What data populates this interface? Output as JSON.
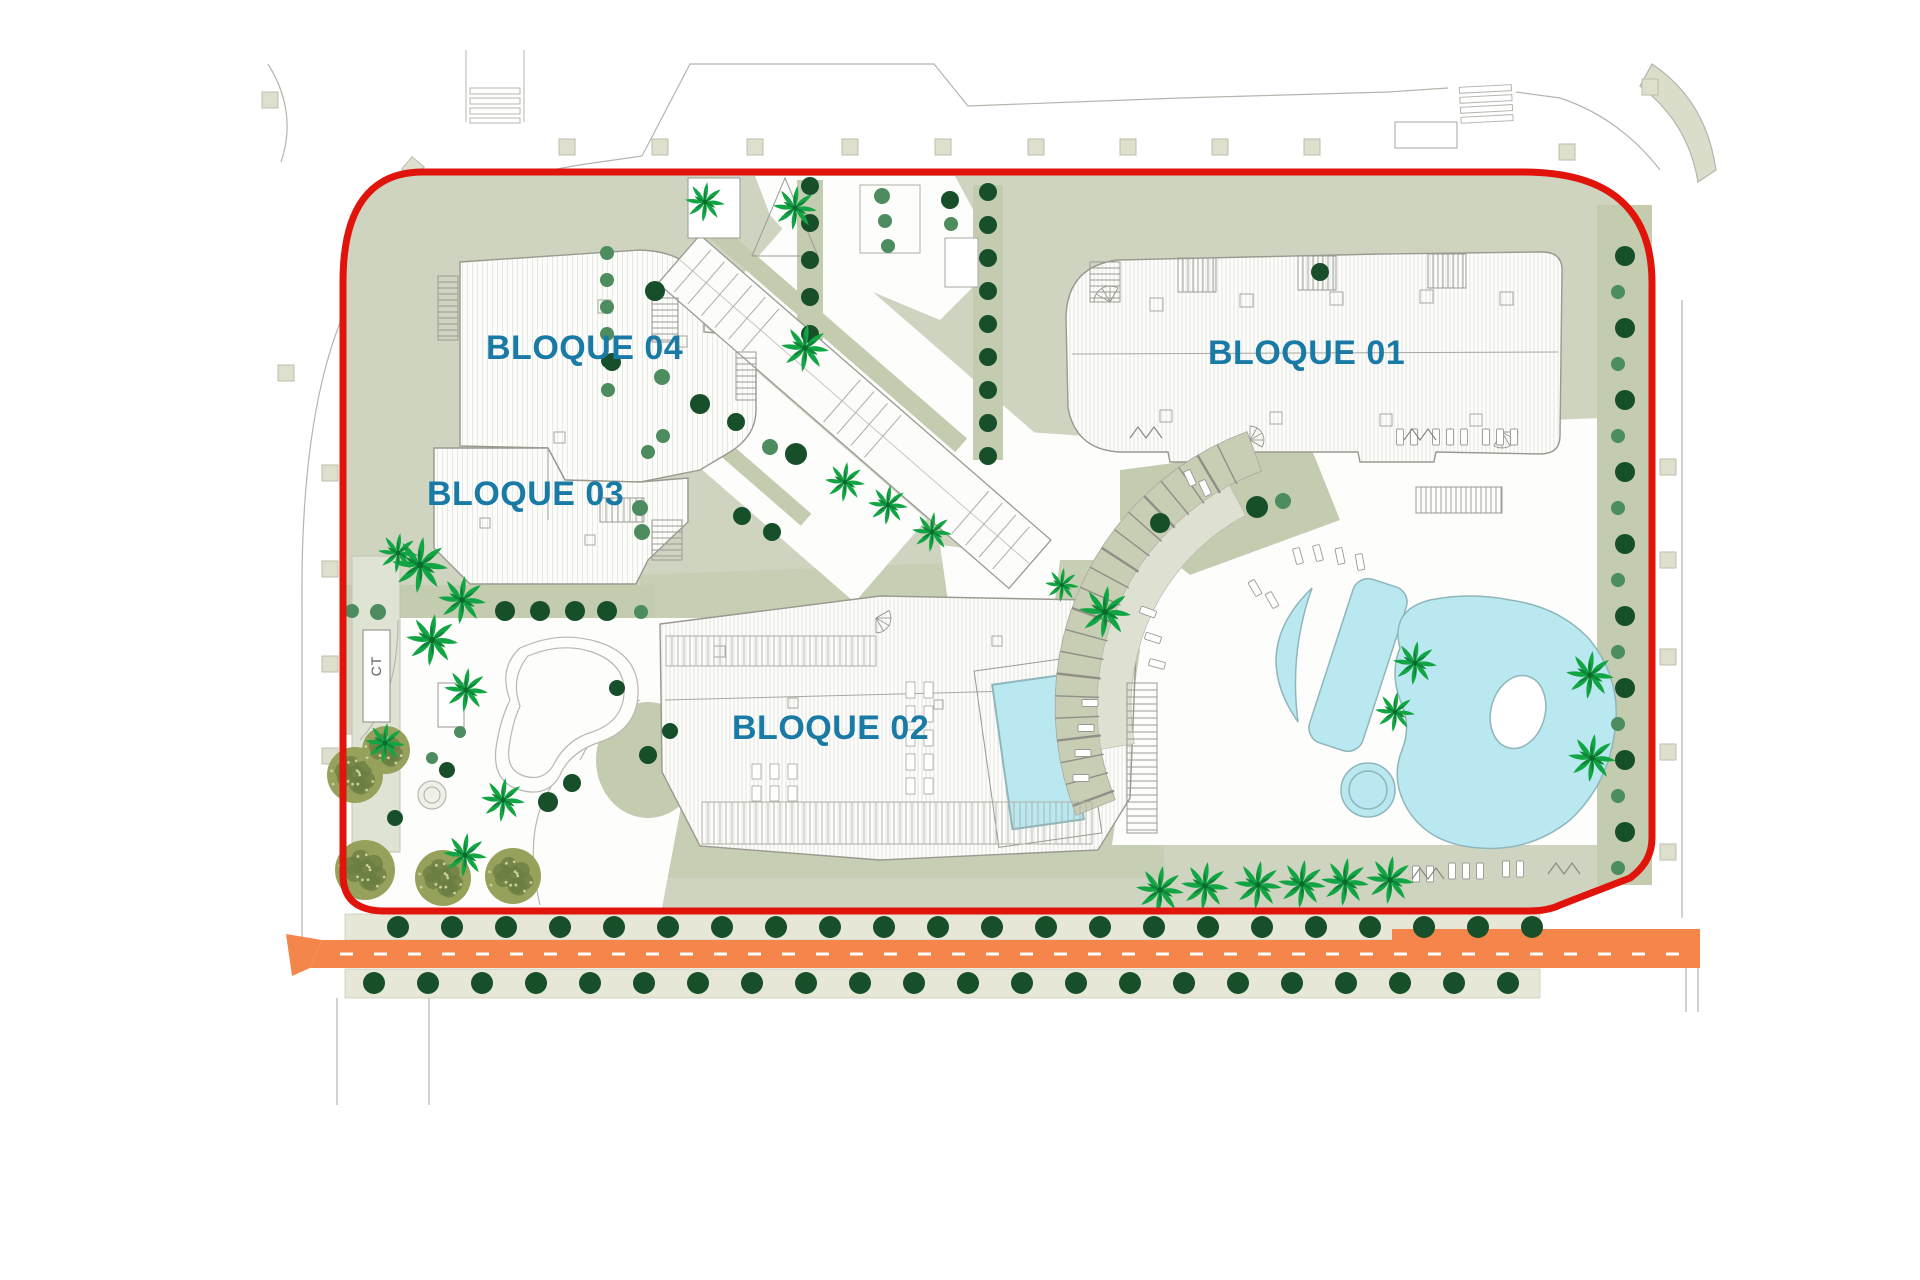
{
  "plan": {
    "type": "residential-site-plan",
    "labels": {
      "block01": "BLOQUE 01",
      "block02": "BLOQUE 02",
      "block03": "BLOQUE 03",
      "block04": "BLOQUE 04",
      "transformer": "CT"
    }
  },
  "colors": {
    "site_green": "#CFD4C0",
    "hedge_green": "#C4CCB0",
    "boundary_red": "#E1140C",
    "label_blue": "#1A7AA6",
    "pool_cyan": "#B9E8F1",
    "pool_edge": "#8FB6BA",
    "road_orange": "#F5864B",
    "path_beige": "#E7E7D7",
    "tree_dark": "#174F2B",
    "tree_medium": "#4C8C5E",
    "palm_green": "#12A544",
    "olive_green": "#96A15B",
    "olive_dark": "#6B7D41",
    "line_gray": "#9A9A94",
    "building_white": "#FDFDFB"
  },
  "landscape": {
    "tree_rows": [
      {
        "name": "road-north-row",
        "vertical": false,
        "x0": 398,
        "x1": 1535,
        "y": 927,
        "step": 54,
        "r": 11,
        "type": "d"
      },
      {
        "name": "road-south-row",
        "vertical": false,
        "x0": 374,
        "x1": 1530,
        "y": 983,
        "step": 54,
        "r": 11,
        "type": "d"
      },
      {
        "name": "bloque01-west-hedge-row",
        "vertical": true,
        "x": 988,
        "y0": 192,
        "y1": 458,
        "step": 33,
        "r": 9,
        "type": "d"
      },
      {
        "name": "plaza-west-hedge-row",
        "vertical": true,
        "x": 810,
        "y0": 186,
        "y1": 334,
        "step": 37,
        "r": 9,
        "type": "d"
      },
      {
        "name": "east-boundary-row",
        "vertical": true,
        "x": 1622,
        "y0": 256,
        "y1": 876,
        "step": 36,
        "r": 10,
        "type": "alt"
      }
    ],
    "trees": [
      [
        655,
        291,
        10,
        "d"
      ],
      [
        612,
        362,
        9,
        "d"
      ],
      [
        662,
        377,
        8,
        "m"
      ],
      [
        700,
        404,
        10,
        "d"
      ],
      [
        736,
        422,
        9,
        "d"
      ],
      [
        770,
        447,
        8,
        "m"
      ],
      [
        796,
        454,
        11,
        "d"
      ],
      [
        742,
        516,
        9,
        "d"
      ],
      [
        772,
        532,
        9,
        "d"
      ],
      [
        882,
        196,
        8,
        "m"
      ],
      [
        885,
        221,
        7,
        "m"
      ],
      [
        888,
        246,
        7,
        "m"
      ],
      [
        950,
        200,
        9,
        "d"
      ],
      [
        951,
        224,
        7,
        "m"
      ],
      [
        1320,
        272,
        9,
        "d"
      ],
      [
        1160,
        523,
        10,
        "d"
      ],
      [
        1257,
        507,
        11,
        "d"
      ],
      [
        1283,
        501,
        8,
        "m"
      ],
      [
        648,
        452,
        7,
        "m"
      ],
      [
        663,
        436,
        7,
        "m"
      ],
      [
        640,
        508,
        8,
        "m"
      ],
      [
        642,
        532,
        8,
        "m"
      ],
      [
        607,
        253,
        7,
        "m"
      ],
      [
        607,
        280,
        7,
        "m"
      ],
      [
        607,
        307,
        7,
        "m"
      ],
      [
        607,
        334,
        7,
        "m"
      ],
      [
        608,
        361,
        7,
        "d"
      ],
      [
        608,
        390,
        7,
        "m"
      ],
      [
        352,
        611,
        7,
        "m"
      ],
      [
        378,
        612,
        8,
        "m"
      ],
      [
        505,
        611,
        10,
        "d"
      ],
      [
        540,
        611,
        10,
        "d"
      ],
      [
        575,
        611,
        10,
        "d"
      ],
      [
        607,
        611,
        10,
        "d"
      ],
      [
        641,
        612,
        7,
        "m"
      ],
      [
        447,
        770,
        8,
        "d"
      ],
      [
        395,
        818,
        8,
        "d"
      ],
      [
        548,
        802,
        10,
        "d"
      ],
      [
        572,
        783,
        9,
        "d"
      ],
      [
        648,
        755,
        9,
        "d"
      ],
      [
        670,
        731,
        8,
        "d"
      ],
      [
        617,
        688,
        8,
        "d"
      ],
      [
        432,
        758,
        6,
        "m"
      ],
      [
        460,
        732,
        6,
        "m"
      ]
    ],
    "palms": [
      [
        705,
        202,
        20
      ],
      [
        795,
        208,
        22
      ],
      [
        805,
        348,
        24
      ],
      [
        845,
        482,
        20
      ],
      [
        888,
        505,
        20
      ],
      [
        932,
        532,
        20
      ],
      [
        1062,
        585,
        17
      ],
      [
        1105,
        612,
        26
      ],
      [
        420,
        565,
        28
      ],
      [
        462,
        600,
        24
      ],
      [
        432,
        640,
        26
      ],
      [
        466,
        690,
        22
      ],
      [
        398,
        553,
        20
      ],
      [
        503,
        800,
        22
      ],
      [
        465,
        855,
        22
      ],
      [
        385,
        743,
        20
      ],
      [
        1160,
        890,
        24
      ],
      [
        1205,
        886,
        24
      ],
      [
        1258,
        885,
        24
      ],
      [
        1302,
        884,
        24
      ],
      [
        1345,
        882,
        24
      ],
      [
        1390,
        880,
        24
      ],
      [
        1415,
        663,
        22
      ],
      [
        1395,
        712,
        20
      ],
      [
        1590,
        675,
        24
      ],
      [
        1592,
        758,
        24
      ]
    ],
    "olive_trees": [
      [
        355,
        775,
        28
      ],
      [
        365,
        870,
        30
      ],
      [
        443,
        878,
        28
      ],
      [
        513,
        876,
        28
      ],
      [
        386,
        750,
        24
      ]
    ]
  },
  "pool_area": {
    "loungers": [
      [
        1400,
        437,
        0
      ],
      [
        1414,
        437,
        0
      ],
      [
        1436,
        437,
        0
      ],
      [
        1450,
        437,
        0
      ],
      [
        1464,
        437,
        0
      ],
      [
        1486,
        437,
        0
      ],
      [
        1500,
        437,
        0
      ],
      [
        1514,
        437,
        0
      ],
      [
        1298,
        556,
        -15
      ],
      [
        1318,
        553,
        -15
      ],
      [
        1340,
        556,
        -12
      ],
      [
        1360,
        562,
        -10
      ],
      [
        1255,
        588,
        -30
      ],
      [
        1272,
        600,
        -30
      ],
      [
        1190,
        478,
        -25
      ],
      [
        1205,
        488,
        -25
      ],
      [
        1148,
        612,
        -70
      ],
      [
        1153,
        638,
        -72
      ],
      [
        1157,
        664,
        -75
      ],
      [
        1090,
        703,
        90
      ],
      [
        1086,
        728,
        90
      ],
      [
        1083,
        753,
        90
      ],
      [
        1081,
        778,
        90
      ],
      [
        1416,
        874,
        0
      ],
      [
        1430,
        874,
        0
      ],
      [
        1452,
        871,
        0
      ],
      [
        1466,
        871,
        0
      ],
      [
        1480,
        871,
        0
      ],
      [
        1506,
        869,
        0
      ],
      [
        1520,
        869,
        0
      ]
    ],
    "racks": [
      [
        1404,
        440
      ],
      [
        1130,
        438
      ],
      [
        1412,
        879
      ],
      [
        1548,
        874
      ]
    ]
  }
}
